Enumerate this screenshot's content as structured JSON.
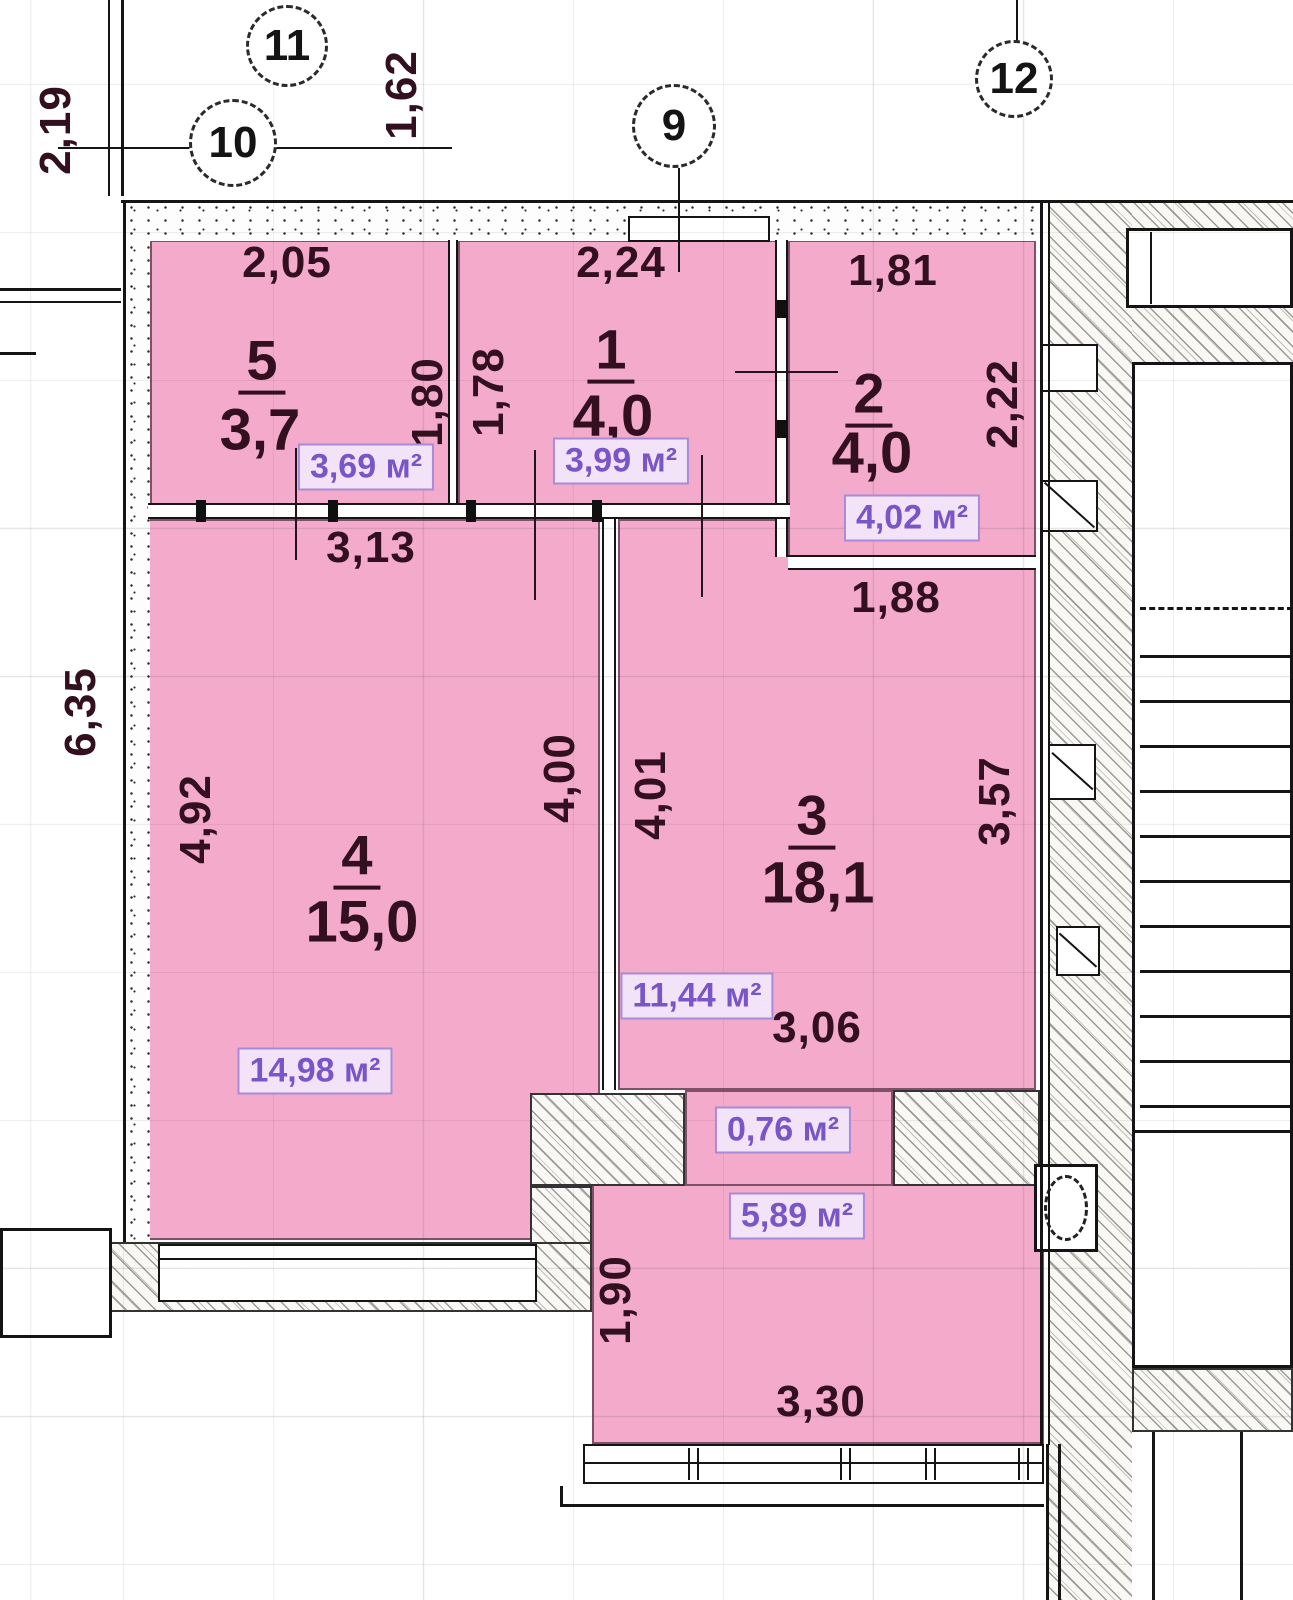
{
  "plan": {
    "title": "apartment floor plan",
    "axis_markers": {
      "m9": "9",
      "m10": "10",
      "m11": "11",
      "m12": "12"
    },
    "outer_dims": {
      "v219": "2,19",
      "v162": "1,62",
      "v635": "6,35"
    },
    "rooms": {
      "r5": {
        "number": "5",
        "area": "3,7",
        "area_label": "3,69 м²",
        "dim_top": "2,05",
        "dim_right": "1,80"
      },
      "r1": {
        "number": "1",
        "area": "4,0",
        "area_label": "3,99 м²",
        "dim_top": "2,24",
        "dim_left": "1,78"
      },
      "r2": {
        "number": "2",
        "area": "4,0",
        "area_label": "4,02 м²",
        "dim_top": "1,81",
        "dim_right": "2,22"
      },
      "r4": {
        "number": "4",
        "area": "15,0",
        "area_label": "14,98 м²",
        "dim_top": "3,13",
        "dim_left": "4,92",
        "dim_right": "4,00"
      },
      "r3": {
        "number": "3",
        "area": "18,1",
        "area_label": "11,44 м²",
        "dim_top": "1,88",
        "dim_left": "4,01",
        "dim_right": "3,57",
        "dim_bottom": "3,06"
      },
      "hall": {
        "area_label": "0,76 м²"
      },
      "bath": {
        "area_label": "5,89 м²",
        "dim_left": "1,90",
        "dim_bottom": "3,30"
      }
    },
    "colors": {
      "room_fill": "#f4aacb",
      "room_border": "#7e5167",
      "area_label_text": "#7a55c8",
      "area_label_bg": "#f2e3f9",
      "dim_text": "#32101f"
    }
  }
}
